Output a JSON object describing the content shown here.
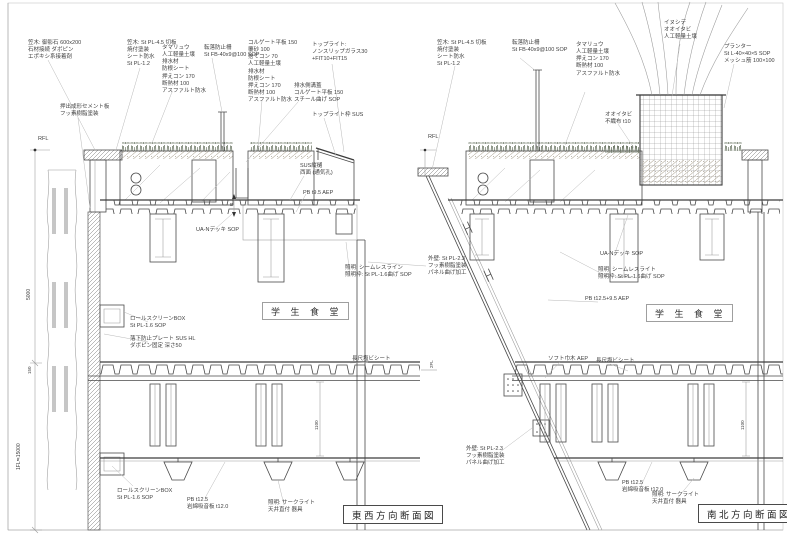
{
  "page": {
    "background": "#ffffff",
    "line_color": "#4a4a4a",
    "grass_color": "#5f6b58",
    "soil_color": "#b6ae9e"
  },
  "titles": {
    "left_section": "東西方向断面図",
    "right_section": "南北方向断面図"
  },
  "rooms": {
    "left": "学 生 食 堂",
    "right": "学 生 食 堂"
  },
  "dims": {
    "rfl_left": "RFL",
    "rfl_right": "RFL",
    "height_left": "5000",
    "level_1fl": "1FL≒15000",
    "d150": "150",
    "fl2": "2FL",
    "h1100_left": "1100",
    "h1100_right": "1100",
    "detail_b": "B"
  },
  "notes": {
    "n01": "笠木: 御影石 600x200\n石材接続 ダボピン\nエポキシ系接着剤",
    "n02": "押出成形セメント板\nフッ素樹脂塗装",
    "n03": "笠木: St PL-4.5 切板\n焼付塗装\nシート防水\nSt PL-1.2",
    "n04": "タマリュウ\n人工軽量土壌\n排水材\n防根シート\n押えコン 170\n断熱材 100\nアスファルト防水",
    "n05": "転落防止柵\nSt FB-40x9@100 SOP",
    "n06": "コルゲート平板 150\n覆砂 100\n捨てコン 70\n人工軽量土壌\n排水材\n防根シート\n押えコン 170\n断熱材 100\nアスファルト防水",
    "n07": "トップライト:\nノンスリップガラス30\n+FIT10+FIT15",
    "n08": "排水側溝蓋\nコルゲート平板 150\nスチール曲げ SOP",
    "n09": "トップライト枠 SUS",
    "n10": "SUS縦樋\n西面 (通気孔)",
    "n11": "PB t9.5 AEP",
    "n12": "UA-Nデッキ SOP",
    "n13": "照明: シームレスライン\n照明枠: St PL-1.6曲げ SOP",
    "n14": "外壁: St PL-2.3\nフッ素樹脂塗装\nパネル曲げ加工",
    "n16": "ロールスクリーンBOX\nSt PL-1.6 SOP",
    "n17": "落下防止プレート SUS HL\nダボピン固定 深さ50",
    "n18": "長尺塩ビシート",
    "n19": "ロールスクリーンBOX\nSt PL-1.6 SOP",
    "n20": "PB t12.5\n岩綿吸音板 t12.0",
    "n21": "照明: サークライト\n天井直付 器具",
    "n22": "笠木: St PL-4.5 切板\n焼付塗装\nシート防水\nSt PL-1.2",
    "n23": "転落防止柵\nSt FB-40x9@100 SOP",
    "n24": "タマリュウ\n人工軽量土壌\n押えコン 170\n断熱材 100\nアスファルト防水",
    "n25": "イヌシデ\nオオイタビ\n人工軽量土壌",
    "n26": "プランター\nSt L-40×40×5 SOP\nメッシュ筋 100×100",
    "n27": "オオイタビ\n不織布 t10",
    "n28": "UA-Nデッキ SOP",
    "n29": "照明: シームレスライト\n照明枠: St PL-1.6曲げ SOP",
    "n30": "PB t12.5+9.5 AEP",
    "n32": "ソフト巾木 AEP",
    "n33": "長尺塩ビシート",
    "n34": "外壁: St PL-2.3\nフッ素樹脂塗装\nパネル曲げ加工",
    "n35": "PB t12.5\n岩綿吸音板 t12.0",
    "n36": "照明: サークライト\n天井直付 器具"
  }
}
